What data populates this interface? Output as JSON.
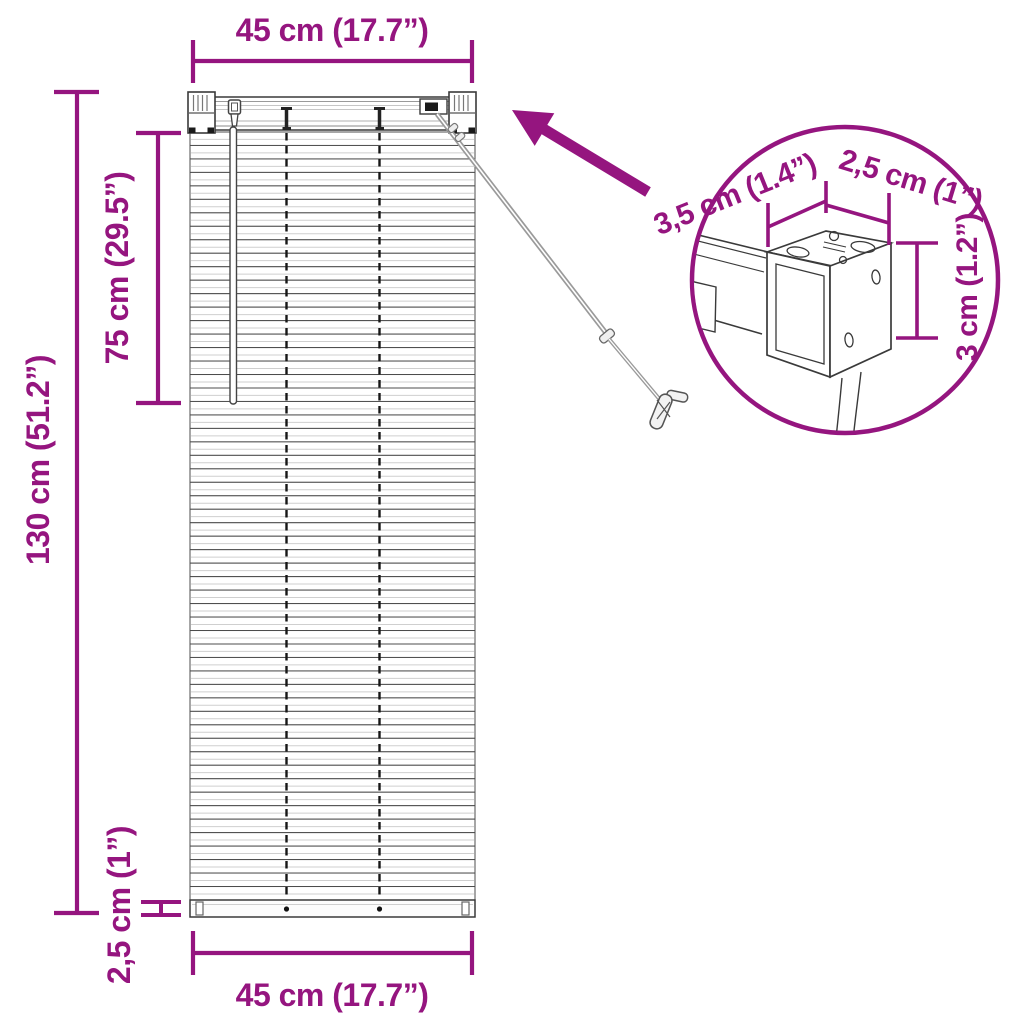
{
  "colors": {
    "accent": "#95157F",
    "line_art": "#3a3a3a",
    "cord": "#9a9a9a"
  },
  "diagram": {
    "top_width_label": "45 cm (17.7”)",
    "bottom_width_label": "45 cm (17.7”)",
    "total_height_label": "130 cm (51.2”)",
    "upper_height_label": "75 cm (29.5”)",
    "bottom_rail_label": "2,5 cm (1”)",
    "inset": {
      "bracket_depth_label": "3,5 cm (1.4”)",
      "bracket_width_label": "2,5 cm (1”)",
      "bracket_height_label": "3 cm (1.2”)"
    }
  },
  "blind": {
    "slat_count": 57
  }
}
